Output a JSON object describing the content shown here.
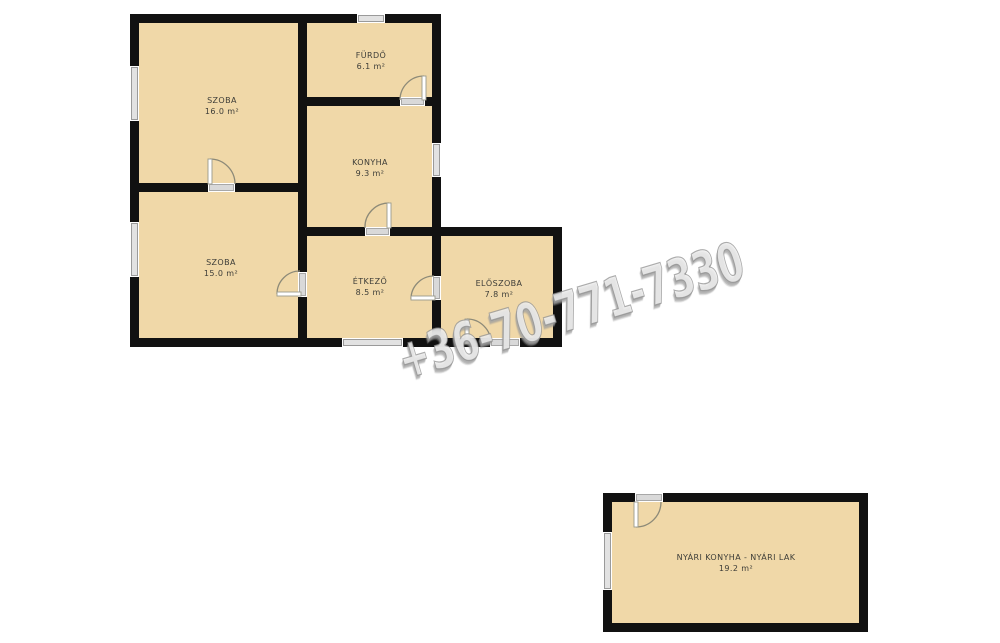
{
  "watermark": {
    "text": "+36-70-771-7330"
  },
  "rooms": [
    {
      "id": "szoba-felso",
      "name": "SZOBA",
      "area": "16.0 m²"
    },
    {
      "id": "furdo",
      "name": "FÜRDŐ",
      "area": "6.1 m²"
    },
    {
      "id": "konyha",
      "name": "KONYHA",
      "area": "9.3 m²"
    },
    {
      "id": "szoba-also",
      "name": "SZOBA",
      "area": "15.0 m²"
    },
    {
      "id": "etkezo",
      "name": "ÉTKEZŐ",
      "area": "8.5 m²"
    },
    {
      "id": "eloszoba",
      "name": "ELŐSZOBA",
      "area": "7.8 m²"
    },
    {
      "id": "nyari-konyha",
      "name": "NYÁRI KONYHA - NYÁRI LAK",
      "area": "19.2 m²"
    }
  ],
  "colors": {
    "room_fill": "#f0d8a8",
    "wall": "#111111",
    "label_text": "#3d3d38",
    "door_arc": "#8d8a78",
    "window_pane_fill": "#e2e2e2",
    "window_pane_border": "#9a9a9a",
    "watermark_gray": "#bdbdbd"
  }
}
